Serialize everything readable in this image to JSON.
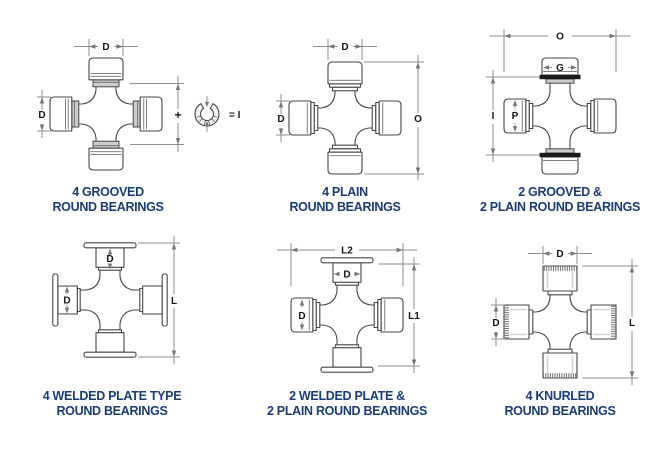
{
  "page": {
    "background": "#ffffff"
  },
  "colors": {
    "caption_text": "#1b3c74",
    "part_outline": "#474747",
    "dimension_lines": "#8f8f8f",
    "groove_shade": "#cccccc",
    "black_groove": "#1a1a1a"
  },
  "diagrams": [
    {
      "name": "4-grooved-round-bearings",
      "caption": [
        "4 GROOVED",
        "ROUND BEARINGS"
      ],
      "labels": {
        "top": "D",
        "left": "D",
        "mid": "+",
        "equals": "= I"
      },
      "icon": "snap-ring-icon"
    },
    {
      "name": "4-plain-round-bearings",
      "caption": [
        "4 PLAIN",
        "ROUND BEARINGS"
      ],
      "labels": {
        "top": "D",
        "left": "D",
        "right": "O"
      }
    },
    {
      "name": "2-grooved-2-plain-round-bearings",
      "caption": [
        "2 GROOVED &",
        "2 PLAIN ROUND BEARINGS"
      ],
      "labels": {
        "top": "O",
        "cap_top": "G",
        "left": "I",
        "cap_left": "P"
      }
    },
    {
      "name": "4-welded-plate-round-bearings",
      "caption": [
        "4 WELDED PLATE TYPE",
        "ROUND BEARINGS"
      ],
      "labels": {
        "cap_top": "D",
        "cap_left": "D",
        "right": "L"
      }
    },
    {
      "name": "2-welded-plate-2-plain-round-bearings",
      "caption": [
        "2 WELDED PLATE &",
        "2 PLAIN ROUND BEARINGS"
      ],
      "labels": {
        "top": "L2",
        "cap_top": "D",
        "cap_left": "D",
        "right": "L1"
      }
    },
    {
      "name": "4-knurled-round-bearings",
      "caption": [
        "4 KNURLED",
        "ROUND BEARINGS"
      ],
      "labels": {
        "top": "D",
        "left": "D",
        "right": "L"
      }
    }
  ]
}
